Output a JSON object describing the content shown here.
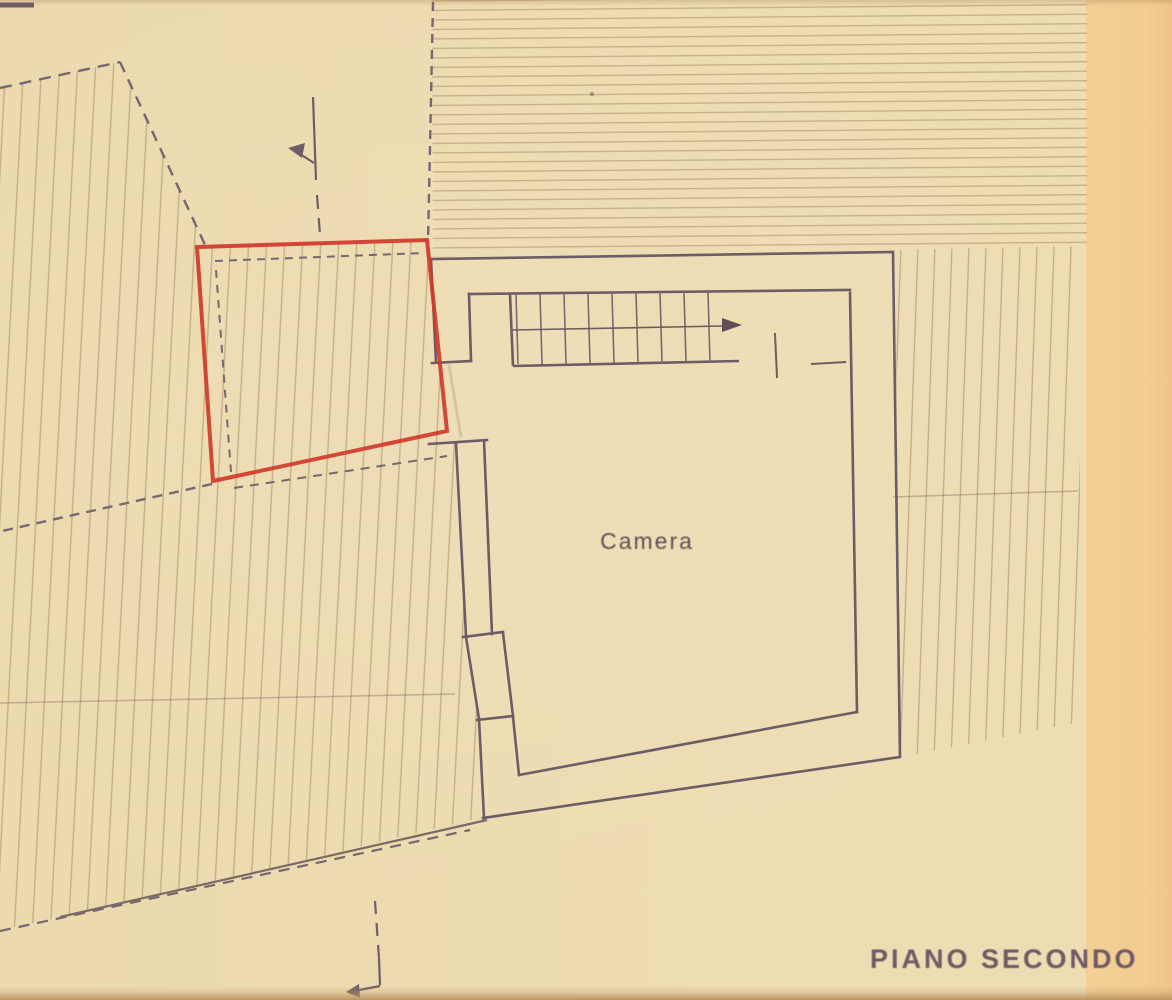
{
  "labels": {
    "room": "Camera",
    "floor": "PIANO SECONDO"
  },
  "colors": {
    "paper": "#eedcb3",
    "paper_right_edge": "#f3cf95",
    "ink_dark": "#6c5c65",
    "hatch_faint": "#9e8060",
    "red_overlay": "#d03a2a"
  },
  "markers": {
    "stair_direction_icon": "right-arrow",
    "section_line_icon": "dashed-section-line-arrow"
  }
}
